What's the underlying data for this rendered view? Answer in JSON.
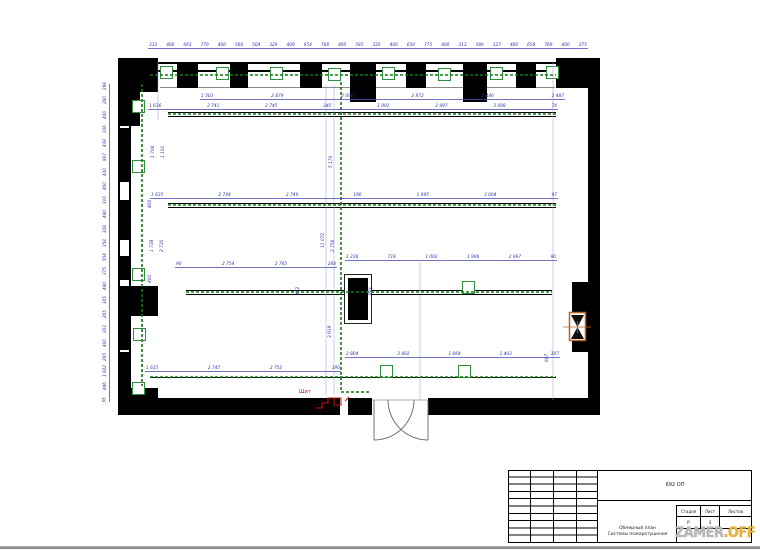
{
  "title_block": {
    "doc_number": "692 ОП",
    "stage_label": "Стадия",
    "sheet_label": "Лист",
    "sheets_label": "Листов",
    "stage_value": "Р",
    "sheet_value": "3",
    "sheets_value": "",
    "title_line1": "Обмерный план",
    "title_line2": "Системы пожаротушения"
  },
  "watermark": {
    "main": "ZAMER",
    "accent": ".OFF",
    "main_color": "#b9b9b9",
    "accent_color": "#e6b23c"
  },
  "plan": {
    "panel_label": "Щит",
    "colors": {
      "wall": "#000000",
      "dimension_blue": "#3434ad",
      "cable_green": "#157815",
      "device_green": "#2f8f3f",
      "panel_red": "#cc1111",
      "valve_orange": "#b4651e"
    }
  },
  "dimensions": {
    "top_row1": [
      "312",
      "400",
      "663",
      "779",
      "400",
      "568",
      "504",
      "329",
      "400",
      "654",
      "768",
      "400",
      "581",
      "335",
      "400",
      "650",
      "775",
      "400",
      "313",
      "586",
      "327",
      "400",
      "658",
      "769",
      "400",
      "275"
    ],
    "top_row2": [
      "1 503",
      "2 879",
      "2 090",
      "2 872",
      "1 446",
      "2 487"
    ],
    "top_row3": [
      "1 636",
      "2 741",
      "2 745",
      "245",
      "1 991",
      "2 997",
      "3 008",
      "74"
    ],
    "run2_row": [
      "1 635",
      "2 744",
      "2 749",
      "190",
      "1 995",
      "3 004",
      "97"
    ],
    "run3_left": [
      "90",
      "2 754",
      "2 765",
      "268"
    ],
    "run3_right": [
      "1 236",
      "718",
      "1 002",
      "1 996",
      "2 997",
      "90"
    ],
    "run4_right": [
      "2 804",
      "3 802",
      "1 064",
      "1 403",
      "107"
    ],
    "run4_left": [
      "1 615",
      "2 747",
      "2 752",
      "190"
    ],
    "left_column": [
      "298",
      "280",
      "400",
      "106",
      "438",
      "907",
      "430",
      "400",
      "310",
      "440",
      "328",
      "358",
      "554",
      "375",
      "440",
      "305",
      "265",
      "303",
      "400",
      "265",
      "1 922",
      "446",
      "55"
    ],
    "interior_vertical": [
      {
        "text": "1 706",
        "x": 152,
        "y": 158
      },
      {
        "text": "1 101",
        "x": 162,
        "y": 158
      },
      {
        "text": "400",
        "x": 149,
        "y": 208
      },
      {
        "text": "1 738",
        "x": 151,
        "y": 252
      },
      {
        "text": "2 730",
        "x": 161,
        "y": 252
      },
      {
        "text": "400",
        "x": 149,
        "y": 283
      },
      {
        "text": "5 170",
        "x": 330,
        "y": 168
      },
      {
        "text": "11 072",
        "x": 322,
        "y": 248
      },
      {
        "text": "2 756",
        "x": 332,
        "y": 252
      },
      {
        "text": "3 919",
        "x": 329,
        "y": 338
      },
      {
        "text": "601",
        "x": 369,
        "y": 295
      },
      {
        "text": "472",
        "x": 297,
        "y": 295
      },
      {
        "text": "607",
        "x": 546,
        "y": 362
      }
    ]
  }
}
